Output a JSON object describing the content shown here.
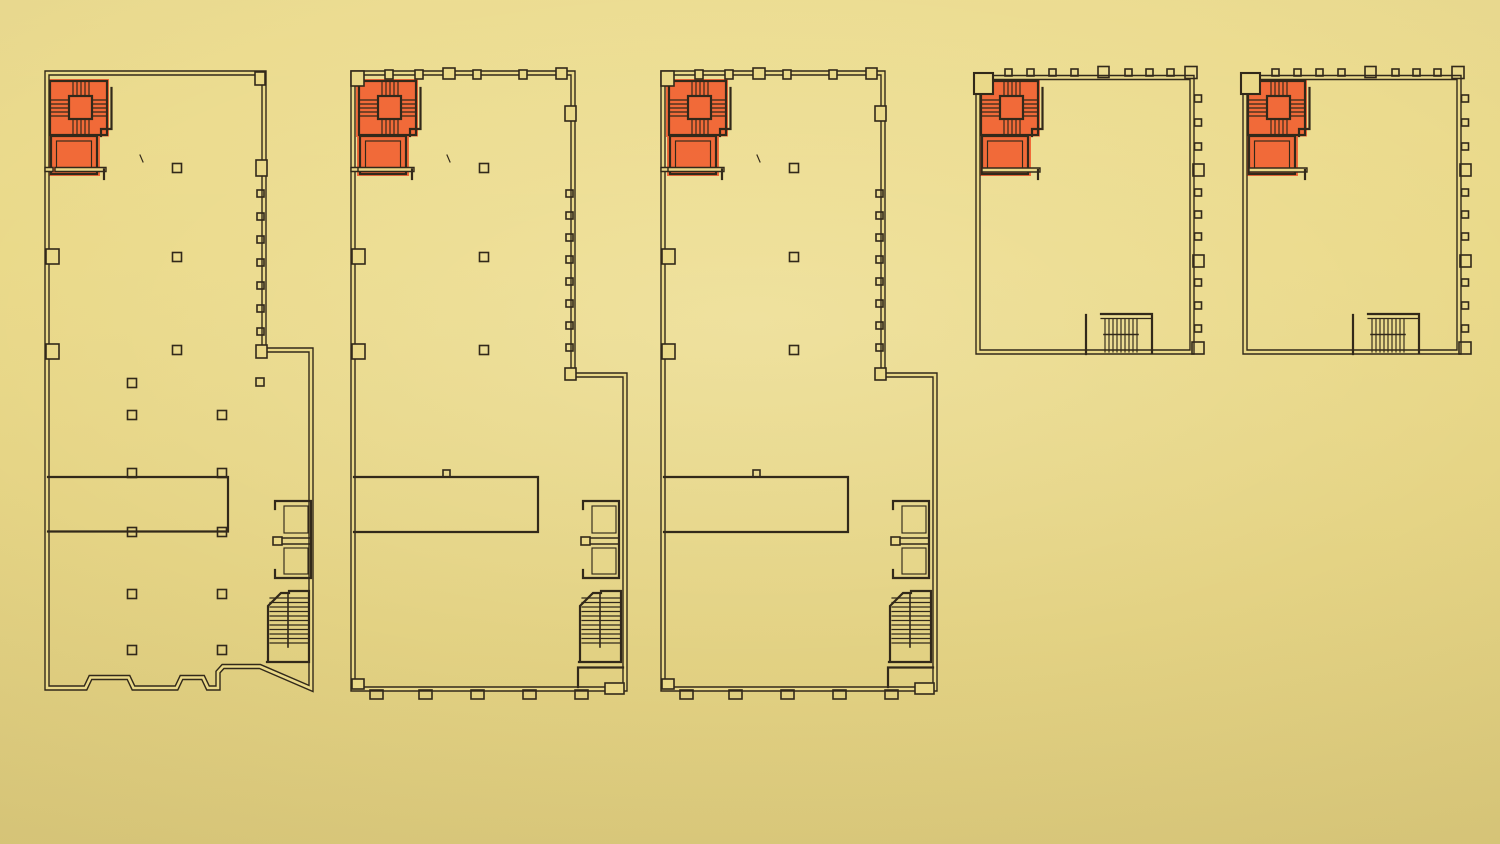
{
  "sheet": {
    "kind": "architectural-floor-plan-drawing",
    "plan_count": 5,
    "visible_text": ""
  },
  "colors": {
    "paper": "#ead989",
    "ink": "#32291a",
    "highlight": "#f15a2c"
  },
  "plans": [
    {
      "id": "floor-plan-1",
      "shape": "deep-rectangular",
      "stair_core_highlighted": true,
      "interior_columns": true,
      "side_annex": true,
      "perimeter_window_ticks": false
    },
    {
      "id": "floor-plan-2",
      "shape": "deep-rectangular",
      "stair_core_highlighted": true,
      "interior_columns": true,
      "side_annex": true,
      "perimeter_window_ticks": true
    },
    {
      "id": "floor-plan-3",
      "shape": "deep-rectangular",
      "stair_core_highlighted": true,
      "interior_columns": true,
      "side_annex": true,
      "perimeter_window_ticks": true
    },
    {
      "id": "floor-plan-4",
      "shape": "compact-square",
      "stair_core_highlighted": true,
      "interior_columns": false,
      "side_annex": false,
      "perimeter_window_ticks": true
    },
    {
      "id": "floor-plan-5",
      "shape": "compact-square",
      "stair_core_highlighted": true,
      "interior_columns": false,
      "side_annex": false,
      "perimeter_window_ticks": true
    }
  ]
}
